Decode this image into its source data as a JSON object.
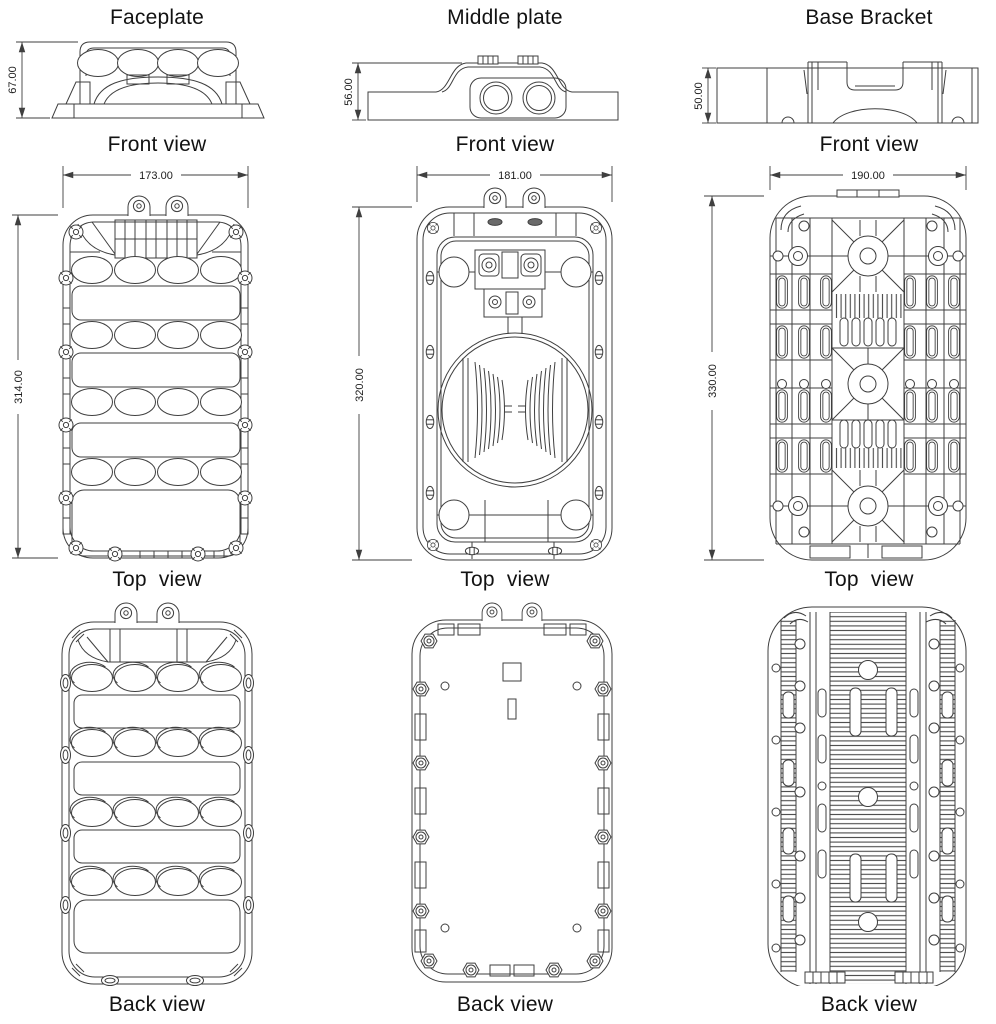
{
  "sheet": {
    "background": "#ffffff",
    "line_color": "#3f3f3f",
    "text_color": "#121212"
  },
  "columns": [
    {
      "title": "Faceplate",
      "front_label": "Front view",
      "top_label": "Top  view",
      "back_label": "Back view",
      "front_height": "67.00",
      "top_width": "173.00",
      "top_height": "314.00"
    },
    {
      "title": "Middle plate",
      "front_label": "Front view",
      "top_label": "Top  view",
      "back_label": "Back view",
      "front_height": "56.00",
      "top_width": "181.00",
      "top_height": "320.00"
    },
    {
      "title": "Base Bracket",
      "front_label": "Front view",
      "top_label": "Top  view",
      "back_label": "Back view",
      "front_height": "50.00",
      "top_width": "190.00",
      "top_height": "330.00"
    }
  ]
}
